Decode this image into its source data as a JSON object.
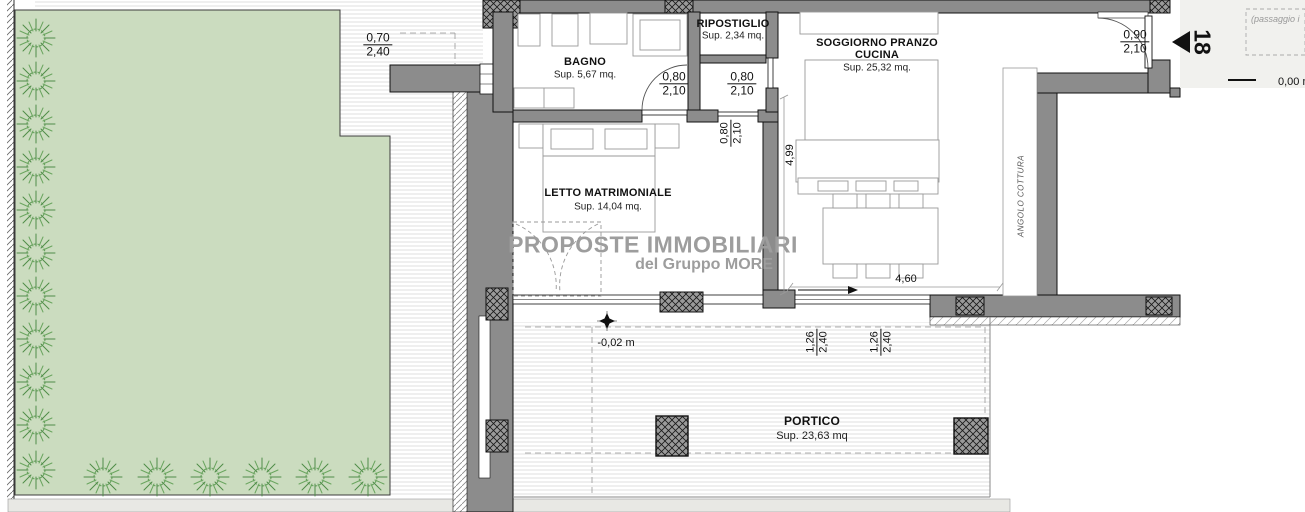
{
  "plan": {
    "watermark": {
      "line1": "PROPOSTE IMMOBILIARI",
      "line2": "del Gruppo MORE"
    },
    "rooms": {
      "bagno": {
        "name": "BAGNO",
        "area": "Sup. 5,67 mq."
      },
      "ripostiglio": {
        "name": "RIPOSTIGLIO",
        "area": "Sup. 2,34 mq."
      },
      "soggiorno": {
        "name": "SOGGIORNO PRANZO",
        "name2": "CUCINA",
        "area": "Sup. 25,32 mq."
      },
      "letto": {
        "name": "LETTO MATRIMONIALE",
        "area": "Sup. 14,04 mq."
      },
      "portico": {
        "name": "PORTICO",
        "area": "Sup. 23,63 mq"
      },
      "angolo_cottura": {
        "name": "ANGOLO COTTURA"
      }
    },
    "dimensions": {
      "window_west": {
        "w": "0,70",
        "h": "2,40"
      },
      "door_bagno": {
        "w": "0,80",
        "h": "2,10"
      },
      "door_ripostiglio": {
        "w": "0,80",
        "h": "2,10"
      },
      "door_letto": {
        "w": "0,80",
        "h": "2,10"
      },
      "door_entrance": {
        "w": "0,90",
        "h": "2,10"
      },
      "soggiorno_depth": "4,99",
      "window_width": "4,60",
      "portico_left": {
        "w": "1,26",
        "h": "2,40"
      },
      "portico_right": {
        "w": "1,26",
        "h": "2,40"
      },
      "level_portico": "-0,02 m",
      "level_entrance": "0,00 m"
    },
    "annotations": {
      "unit_number": "18",
      "passage_note": "(passaggio i"
    },
    "colors": {
      "garden": "#cbdcbf",
      "shrub": "#4f8d48",
      "wall": "#8c8c8c",
      "stripe": "#dcdcdc",
      "watermark": "#9d9d9d"
    }
  }
}
